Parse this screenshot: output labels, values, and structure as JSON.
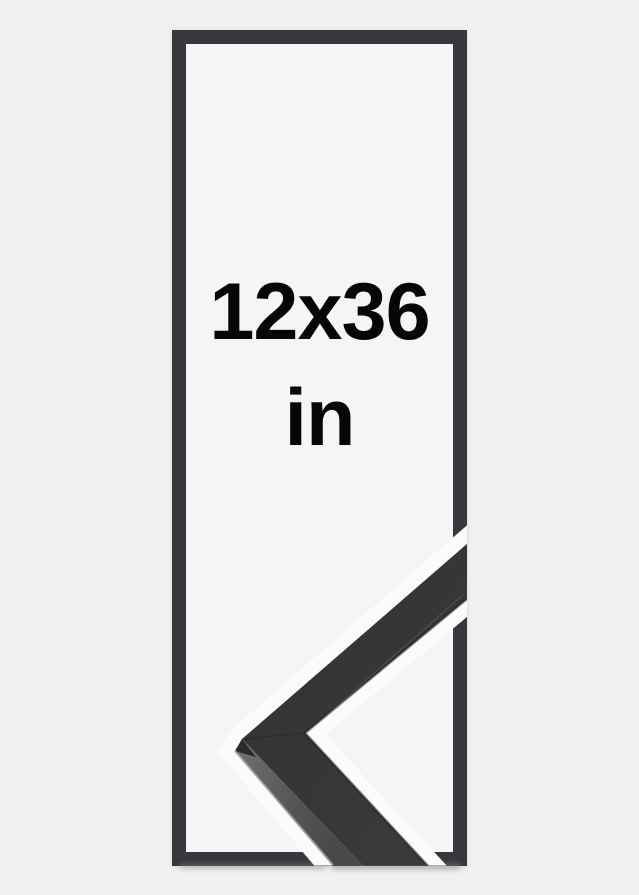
{
  "image": {
    "type": "product-size-illustration",
    "description": "Picture frame size mock-up: tall rectangle outline with size text and a photographic black frame corner sample overlapping the lower right"
  },
  "size_diagram": {
    "label_line1": "12x36",
    "label_line2": "in"
  },
  "frame_sample": {
    "name": "black-frame-corner-sample",
    "style": "matte black wooden moulding, mitred corner pointing left"
  },
  "colors": {
    "background": "#f0f1f1",
    "interior": "#f4f5f6",
    "outline": "#36383b",
    "text": "#060607",
    "moulding_front_dark": "#2f3133",
    "moulding_front_light": "#3a3c3e",
    "moulding_side": "#5d5e60",
    "halo": "#fbfbfc"
  }
}
